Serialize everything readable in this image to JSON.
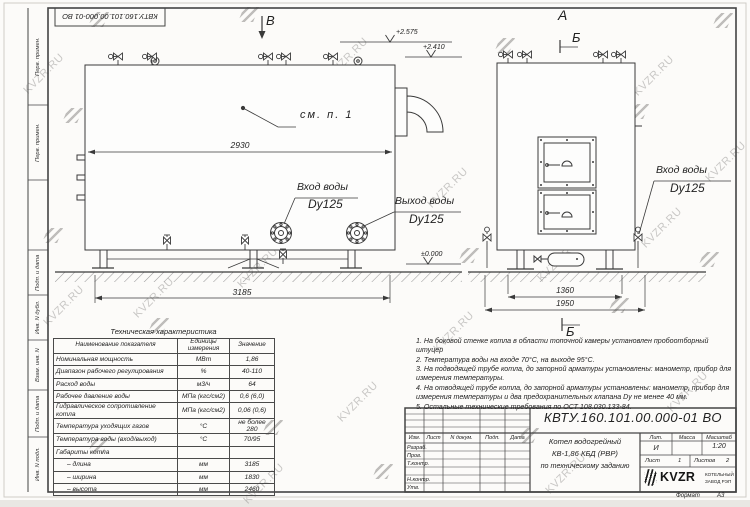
{
  "watermark": {
    "text": "KVZR.RU"
  },
  "stamp_top": {
    "code": "КВТУ.160.101.00.000-01 ВО"
  },
  "margin_labels": {
    "box1": "Перв. примен.",
    "box2": "Перв. примен.",
    "box3": "Подп. и дата",
    "box4": "Инв. N дубл.",
    "box5": "Взам. инв. N",
    "box6": "Подп. и дата",
    "box7": "Инв. N подл."
  },
  "views": {
    "left": {
      "section_mark": "В",
      "elev_valves": "+2.575",
      "elev_top": "+2.410",
      "see_note": "см. п. 1",
      "dim_body": "2930",
      "inlet_label": "Вход воды",
      "inlet_dn": "Dy125",
      "outlet_label": "Выход воды",
      "outlet_dn": "Dy125",
      "elev_zero": "±0.000",
      "dim_length": "3185"
    },
    "right": {
      "view_mark": "А",
      "section_mark_top": "Б",
      "section_mark_bottom": "Б",
      "inlet_label": "Вход воды",
      "inlet_dn": "Dy125",
      "dim_inner": "1360",
      "dim_outer": "1950"
    }
  },
  "tech_table": {
    "title": "Техническая характеристика",
    "headers": [
      "Наименование показателя",
      "Единицы измерения",
      "Значение"
    ],
    "rows": [
      [
        "Номинальная мощность",
        "МВт",
        "1,86"
      ],
      [
        "Диапазон рабочего регулирования",
        "%",
        "40-110"
      ],
      [
        "Расход воды",
        "м3/ч",
        "64"
      ],
      [
        "Рабочее давление воды",
        "МПа (кгс/см2)",
        "0,6 (6,0)"
      ],
      [
        "Гидравлическое сопротивление котла",
        "МПа (кгс/см2)",
        "0,06 (0,6)"
      ],
      [
        "Температура уходящих газов",
        "°С",
        "не более 280"
      ],
      [
        "Температура воды (вход/выход)",
        "°С",
        "70/95"
      ],
      [
        "Габариты котла",
        "",
        ""
      ],
      [
        "– длина",
        "мм",
        "3185"
      ],
      [
        "– ширина",
        "мм",
        "1830"
      ],
      [
        "– высота",
        "мм",
        "2460"
      ]
    ]
  },
  "notes": {
    "items": [
      "1. На боковой стенке котла в области топочной камеры установлен пробоотборный штуцер",
      "2. Температура воды на входе 70°С, на выходе 95°С.",
      "3. На подводящей трубе котла, до запорной арматуры установлены: манометр, прибор для измерения температуры.",
      "4. На отводящей трубе котла, до запорной арматуры установлены: манометр, прибор для измерения температуры и два предохранительных клапана Dу не менее 40 мм.",
      "5. Остальные технические требования по ОСТ 108.030.133-84."
    ]
  },
  "title_block": {
    "doc_number": "КВТУ.160.101.00.000-01 ВО",
    "col_izm": "Изм.",
    "col_list": "Лист",
    "col_doc": "N докум.",
    "col_podp": "Подп.",
    "col_data": "Дата",
    "row_razrab": "Разраб.",
    "row_prov": "Пров.",
    "row_tkontr": "Т.контр.",
    "row_nkontr": "Н.контр.",
    "row_utv": "Утв.",
    "title_line1": "Котел водогрейный",
    "title_line2": "КВ-1,86 КБД (РВР)",
    "title_line3": "по техническому заданию",
    "lit_label": "Лит.",
    "lit_value": "И",
    "mass_label": "Масса",
    "scale_label": "Масштаб",
    "scale_value": "1:20",
    "sheet_label": "Лист",
    "sheet_value": "1",
    "sheets_label": "Листов",
    "sheets_value": "2",
    "logo_text": "KVZR",
    "logo_sub1": "КОТЕЛЬНЫЙ",
    "logo_sub2": "ЗАВОД РЭП",
    "format_label": "Формат",
    "format_value": "А3"
  },
  "icons": {
    "kvzr_logo": "coil-spring",
    "watermark_mark": "diagonal-stripes",
    "elevation_mark": "open-v-check"
  },
  "colors": {
    "line": "#3a3a3a",
    "paper": "#fcfbf9",
    "watermark": "#918f8c"
  }
}
